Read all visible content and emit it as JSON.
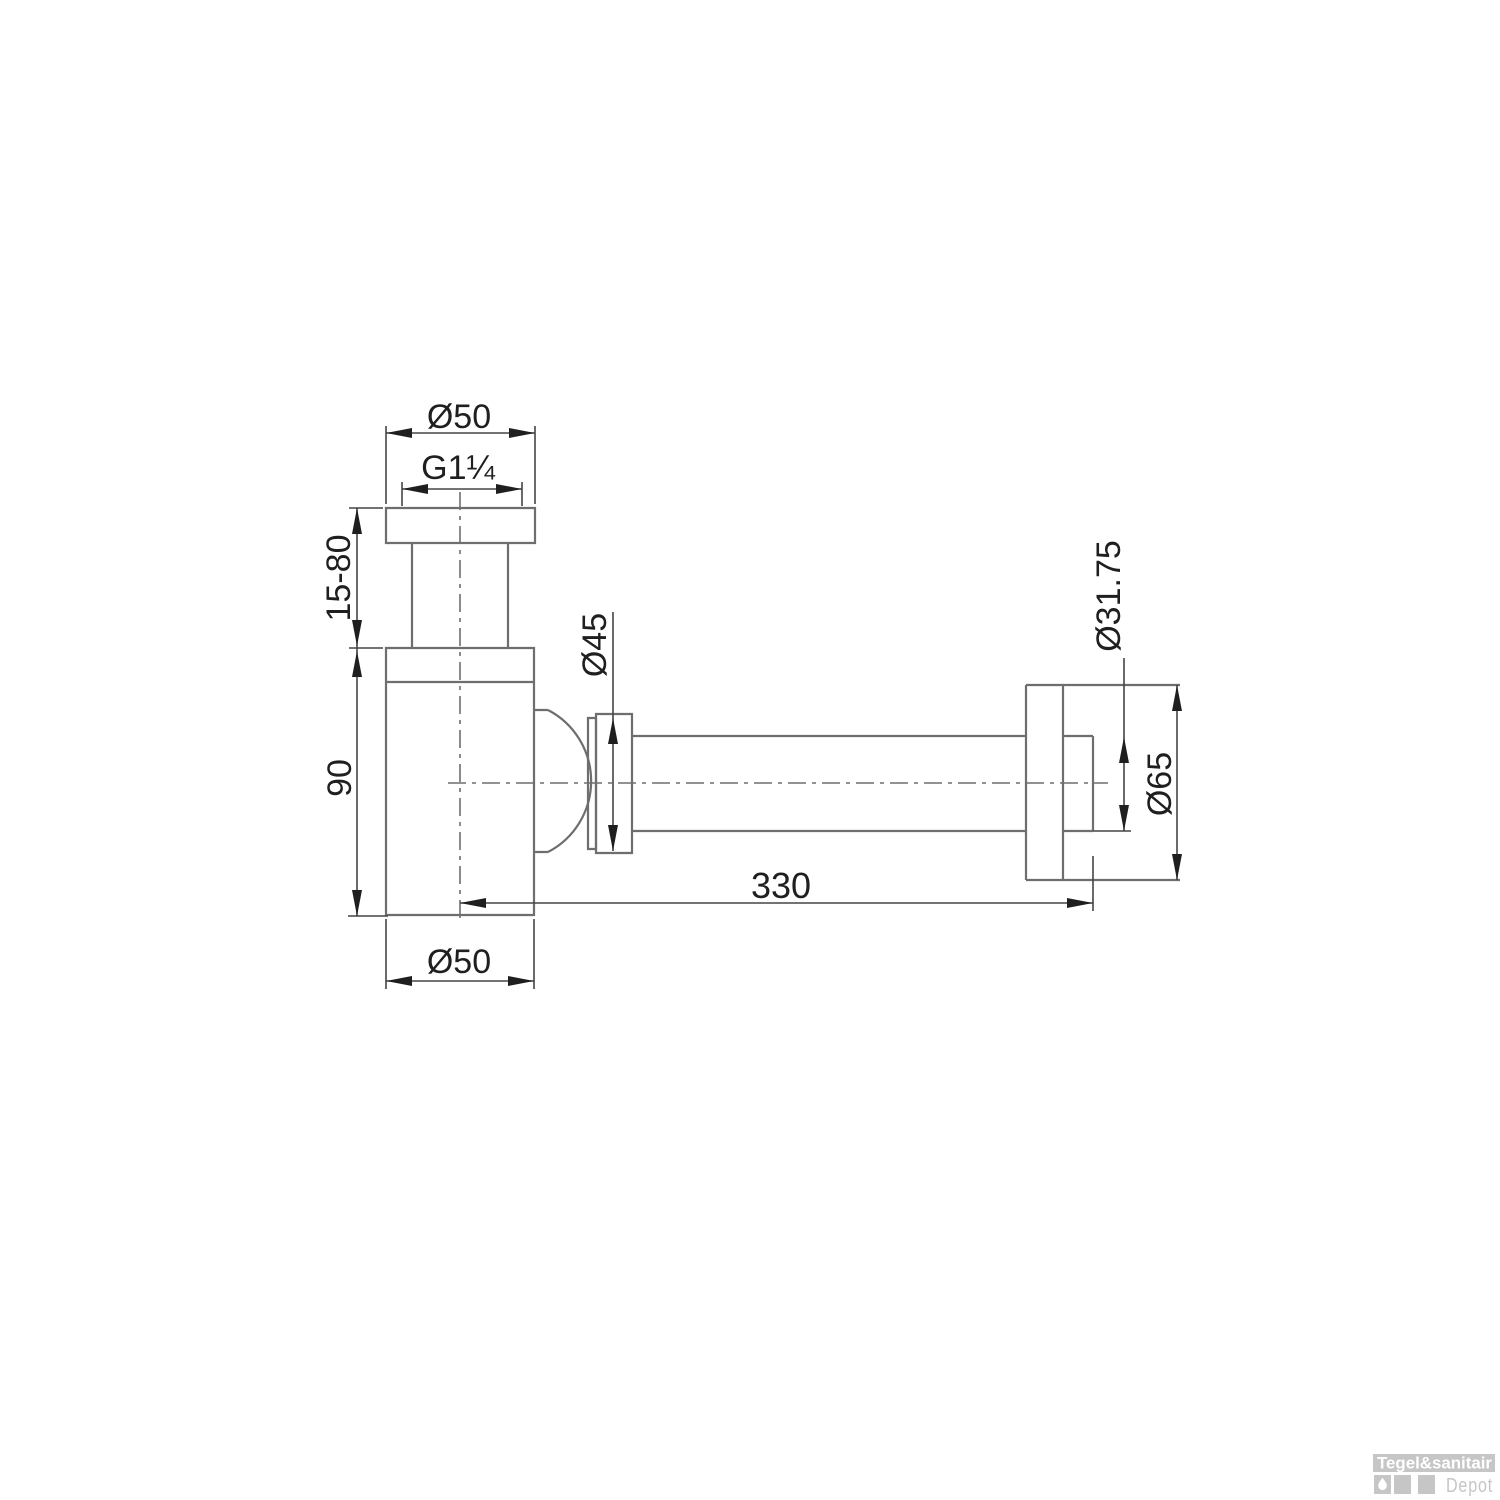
{
  "drawing": {
    "labels": {
      "top_diameter": "Ø50",
      "thread_size": "G1¼",
      "height_adjust_range": "15-80",
      "body_height": "90",
      "nut_diameter": "Ø45",
      "body_diameter": "Ø50",
      "pipe_length": "330",
      "pipe_diameter": "Ø31.75",
      "rosette_diameter": "Ø65"
    }
  },
  "watermark": {
    "brand_top": "Tegel&sanitair",
    "brand_bottom": "Depot"
  },
  "colors": {
    "outline": "#6e6e6e",
    "dimension": "#454545",
    "text": "#1f1f1f",
    "watermark_gray": "#c6c6c6",
    "background": "#ffffff"
  }
}
